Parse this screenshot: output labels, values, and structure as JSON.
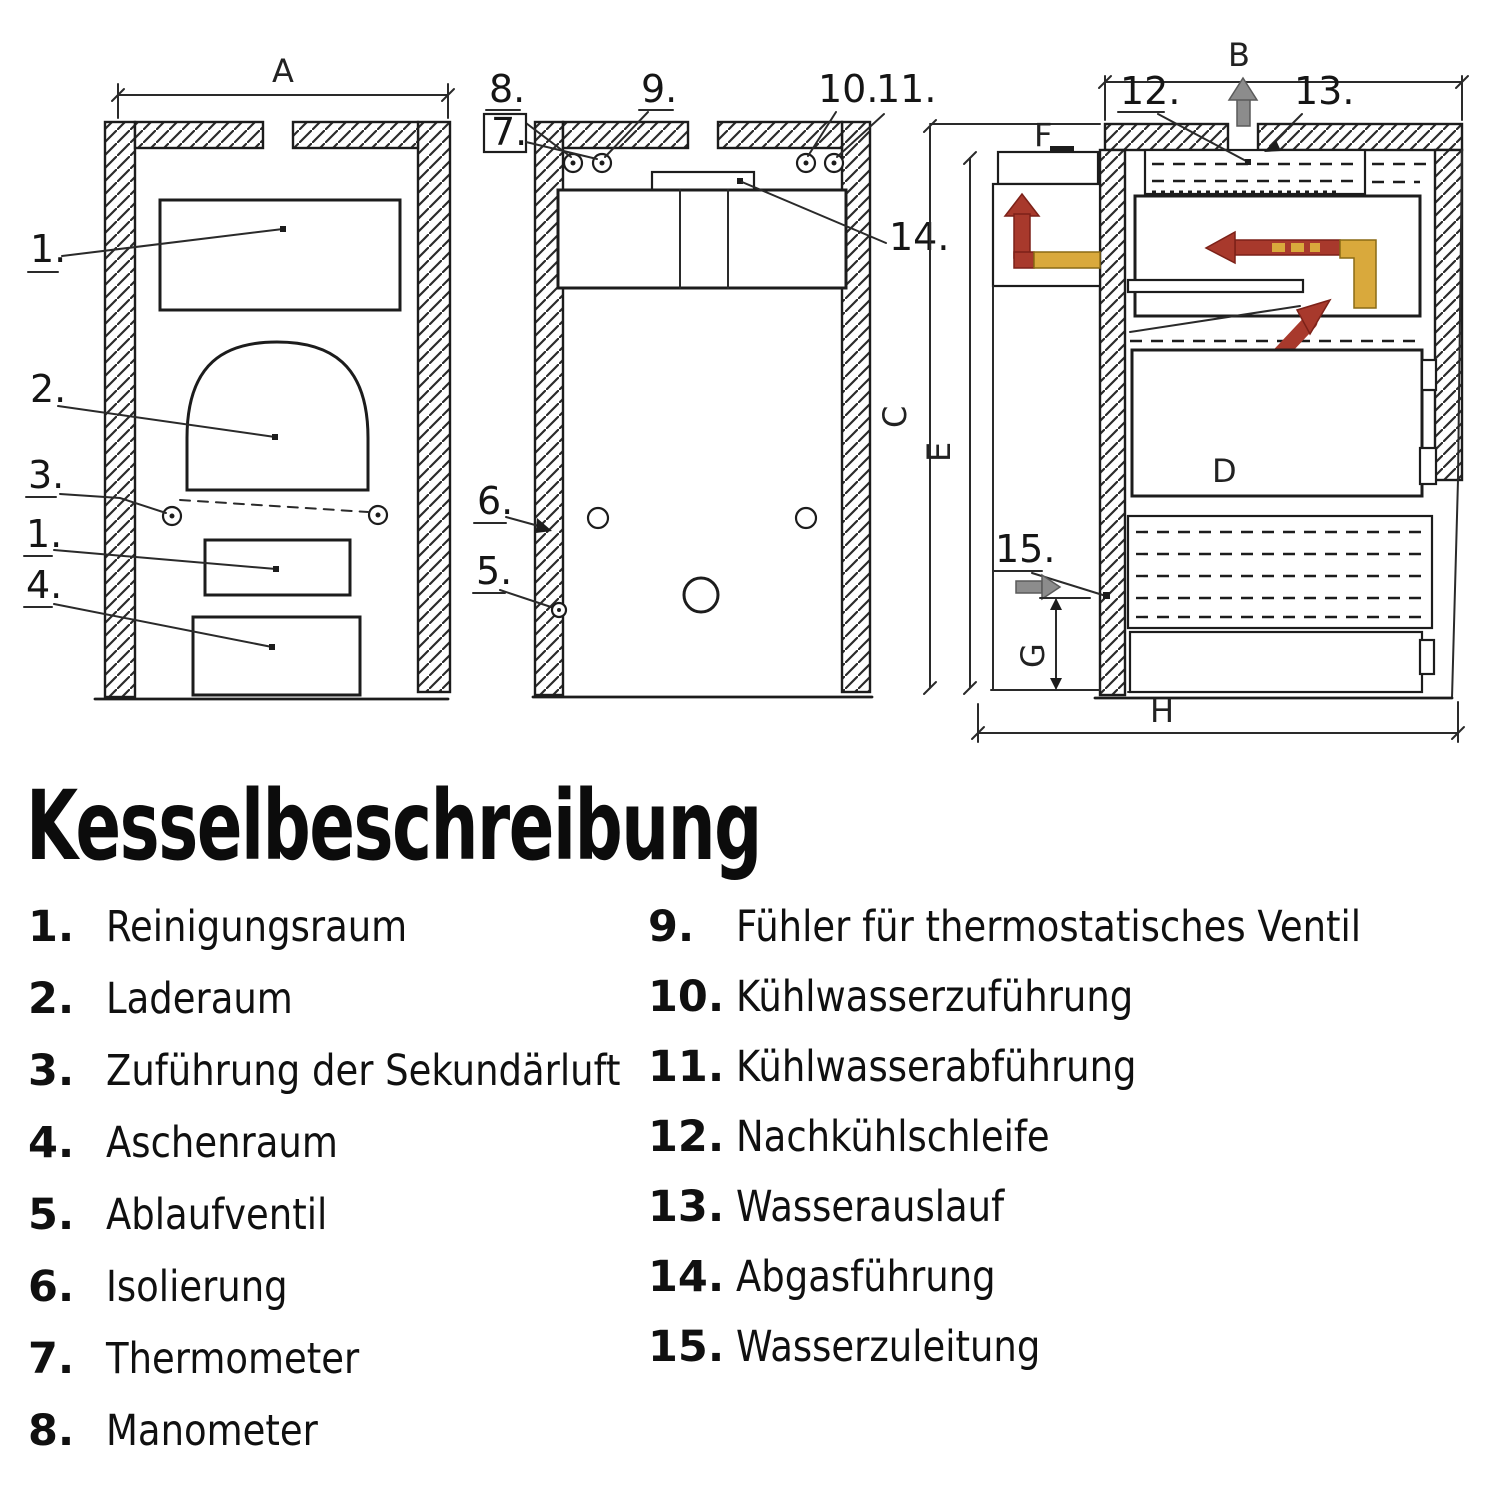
{
  "title": "Kesselbeschreibung",
  "legend": {
    "left": [
      {
        "num": "1.",
        "label": "Reinigungsraum"
      },
      {
        "num": "2.",
        "label": "Laderaum"
      },
      {
        "num": "3.",
        "label": "Zuführung der Sekundärluft"
      },
      {
        "num": "4.",
        "label": "Aschenraum"
      },
      {
        "num": "5.",
        "label": "Ablaufventil"
      },
      {
        "num": "6.",
        "label": "Isolierung"
      },
      {
        "num": "7.",
        "label": "Thermometer"
      },
      {
        "num": "8.",
        "label": "Manometer"
      }
    ],
    "right": [
      {
        "num": "9.",
        "label": "Fühler für thermostatisches Ventil"
      },
      {
        "num": "10.",
        "label": "Kühlwasserzuführung"
      },
      {
        "num": "11.",
        "label": "Kühlwasserabführung"
      },
      {
        "num": "12.",
        "label": "Nachkühlschleife"
      },
      {
        "num": "13.",
        "label": "Wasserauslauf"
      },
      {
        "num": "14.",
        "label": "Abgasführung"
      },
      {
        "num": "15.",
        "label": "Wasserzuleitung"
      }
    ]
  },
  "figure": {
    "callouts": {
      "n1": "1.",
      "n2": "2.",
      "n3": "3.",
      "n1b": "1.",
      "n4": "4.",
      "n5": "5.",
      "n6": "6.",
      "n7": "7.",
      "n8": "8.",
      "n9": "9.",
      "n10": "10.",
      "n11": "11.",
      "n12": "12.",
      "n13": "13.",
      "n14": "14.",
      "n15": "15."
    },
    "dimensions": {
      "a": "A",
      "b": "B",
      "c": "C",
      "d": "D",
      "e": "E",
      "f": "F",
      "g": "G",
      "h": "H"
    },
    "colors": {
      "ink": "#1c1c1c",
      "flow_hot": "#a8392c",
      "flow_warm": "#d9a93c",
      "arrow_gray": "#8c8c8c"
    }
  }
}
